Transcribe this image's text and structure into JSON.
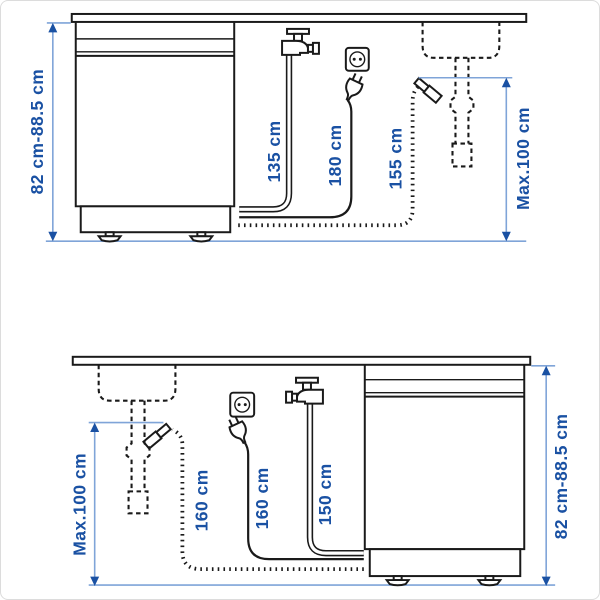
{
  "colors": {
    "drawing_line": "#1a1a1a",
    "dimension_line": "#7fa4d8",
    "label_text": "#1a51a3",
    "background": "#ffffff"
  },
  "icons": {
    "faucet": "water-tap-icon",
    "outlet": "power-outlet-icon",
    "plug": "power-plug-icon",
    "sink": "sink-dashed-icon",
    "drain_connector": "drain-hose-connector-icon",
    "arrow": "dimension-arrowhead"
  },
  "diagrams": [
    {
      "id": "dishwasher-left-sink-right",
      "labels": {
        "height_range": "82 cm-88.5 cm",
        "water_hose": "135 cm",
        "power_cord": "180 cm",
        "drain_hose": "155 cm",
        "max_drain_height": "Max.100 cm"
      }
    },
    {
      "id": "sink-left-dishwasher-right",
      "labels": {
        "max_drain_height": "Max.100 cm",
        "drain_hose": "160 cm",
        "power_cord": "160 cm",
        "water_hose": "150 cm",
        "height_range": "82 cm-88.5 cm"
      }
    }
  ]
}
